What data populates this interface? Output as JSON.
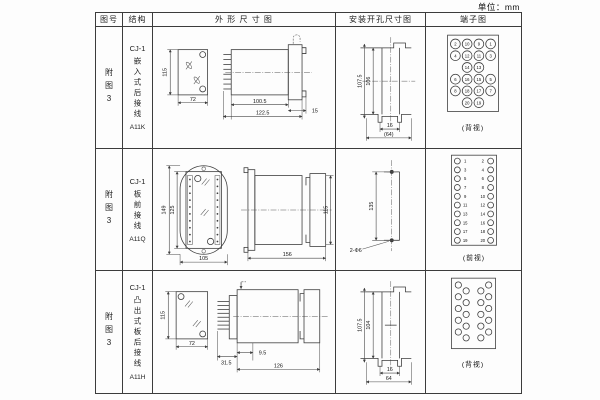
{
  "unit_label": "单位：mm",
  "header": {
    "figure": "图号",
    "structure": "结构",
    "outline": "外 形 尺 寸 图",
    "mounting": "安装开孔尺寸图",
    "terminal": "端子图"
  },
  "rows": [
    {
      "figure": "附图3",
      "structure": {
        "model": "CJ-1",
        "desc": "嵌入式后接线",
        "code": "A11K"
      },
      "outline_dims": {
        "height": "115",
        "width": "72",
        "depth": "100.5",
        "total_depth": "122.5",
        "flange": "15"
      },
      "mounting_dims": {
        "outer_height": "107.5",
        "inner_height": "106",
        "slot_width": "16",
        "panel_width": "(64)"
      },
      "terminal": {
        "caption": "(背视)",
        "numbers": [
          "2",
          "10",
          "9",
          "1",
          "4",
          "12",
          "11",
          "3",
          "14",
          "13",
          "6",
          "16",
          "15",
          "5",
          "8",
          "18",
          "17",
          "7",
          "20",
          "19"
        ]
      }
    },
    {
      "figure": "附图3",
      "structure": {
        "model": "CJ-1",
        "desc": "板前接线",
        "code": "A11Q"
      },
      "outline_dims": {
        "outer_height": "149",
        "inner_height": "125",
        "width": "105",
        "depth": "156",
        "side_height": "115"
      },
      "mounting_dims": {
        "hole_spacing": "135",
        "hole_label": "2-Φ6"
      },
      "terminal": {
        "caption": "(前视)",
        "left_numbers": [
          "1",
          "3",
          "5",
          "7",
          "9",
          "11",
          "13",
          "15",
          "17",
          "19"
        ],
        "right_numbers": [
          "2",
          "4",
          "6",
          "8",
          "10",
          "12",
          "14",
          "16",
          "18",
          "20"
        ]
      }
    },
    {
      "figure": "附图3",
      "structure": {
        "model": "CJ-1",
        "desc": "凸出式板后接线",
        "code": "A11H"
      },
      "outline_dims": {
        "height": "115",
        "width": "72",
        "pin_depth": "31.5",
        "offset": "9.5",
        "depth": "126"
      },
      "mounting_dims": {
        "outer_height": "107.5",
        "inner_height": "104",
        "slot_width": "16",
        "panel_width": "64"
      },
      "terminal": {
        "caption": "(背视)"
      }
    }
  ]
}
